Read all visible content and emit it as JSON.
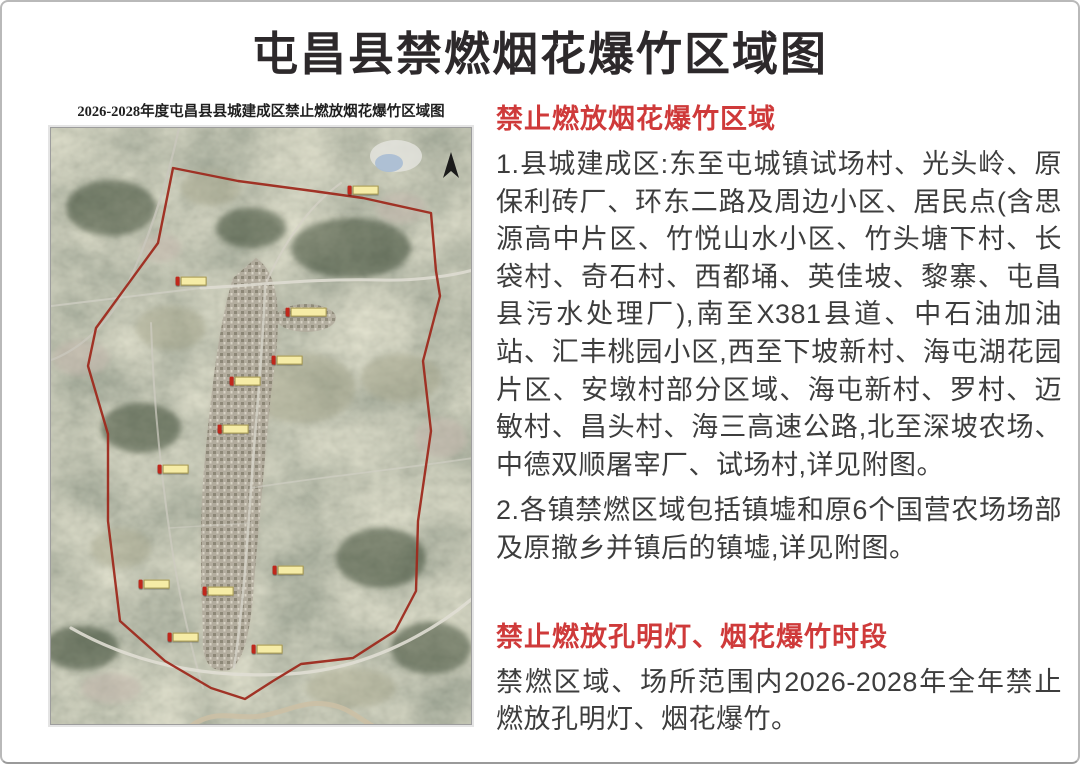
{
  "page": {
    "title": "屯昌县禁燃烟花爆竹区域图"
  },
  "map": {
    "caption": "2026-2028年度屯昌县县城建成区禁止燃放烟花爆竹区域图",
    "north_arrow_icon": "north-arrow",
    "markers": [
      {
        "x": 73.5,
        "y": 10.5
      },
      {
        "x": 32.5,
        "y": 25.9
      },
      {
        "x": 59.7,
        "y": 31.1,
        "w": 36
      },
      {
        "x": 55.5,
        "y": 39.1
      },
      {
        "x": 45.5,
        "y": 42.6
      },
      {
        "x": 42.7,
        "y": 50.7
      },
      {
        "x": 28.4,
        "y": 57.4
      },
      {
        "x": 55.7,
        "y": 74.4
      },
      {
        "x": 23.7,
        "y": 76.6
      },
      {
        "x": 39.1,
        "y": 77.8
      },
      {
        "x": 30.8,
        "y": 85.5
      },
      {
        "x": 50.7,
        "y": 87.5
      }
    ]
  },
  "sections": [
    {
      "heading": "禁止燃放烟花爆竹区域",
      "paragraphs": [
        "1.县城建成区:东至屯城镇试场村、光头岭、原保利砖厂、环东二路及周边小区、居民点(含思源高中片区、竹悦山水小区、竹头塘下村、长袋村、奇石村、西都埇、英佳坡、黎寨、屯昌县污水处理厂),南至X381县道、中石油加油站、汇丰桃园小区,西至下坡新村、海屯湖花园片区、安墩村部分区域、海屯新村、罗村、迈敏村、昌头村、海三高速公路,北至深坡农场、中德双顺屠宰厂、试场村,详见附图。",
        "2.各镇禁燃区域包括镇墟和原6个国营农场场部及原撤乡并镇后的镇墟,详见附图。"
      ]
    },
    {
      "heading": "禁止燃放孔明灯、烟花爆竹时段",
      "paragraphs": [
        "禁燃区域、场所范围内2026-2028年全年禁止燃放孔明灯、烟花爆竹。"
      ]
    }
  ],
  "colors": {
    "accent_red": "#cf3a3a",
    "boundary_red": "#9e2a1e",
    "body_text": "#3d3d3d",
    "marker_tag_yellow": "#f6eca6",
    "marker_pin_red": "#c0271b"
  }
}
